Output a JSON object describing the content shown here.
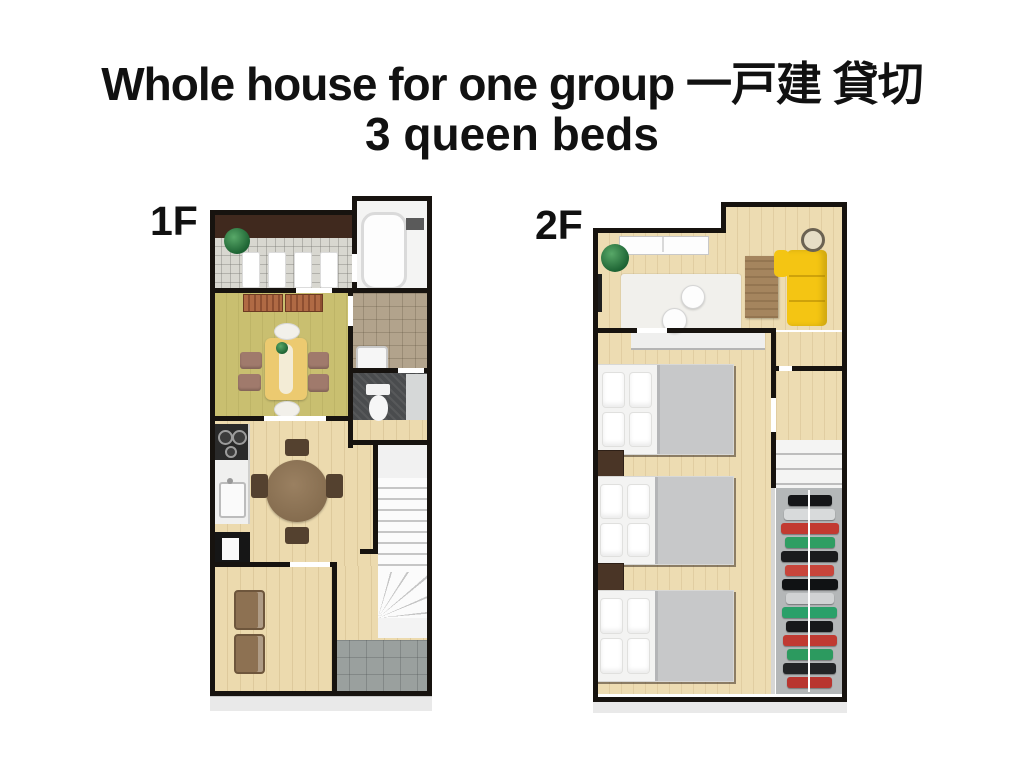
{
  "title": {
    "line1": "Whole house for one group 一戸建 貸切",
    "line2": "3 queen beds"
  },
  "floors": [
    {
      "label": "1F"
    },
    {
      "label": "2F"
    }
  ],
  "palette": {
    "background": "#ffffff",
    "text": "#111111",
    "wall": "#17130f",
    "wall-face": "#e9e9e9",
    "wood-floor": "#ecdaae",
    "wood-floor-2": "#eddcb2",
    "olive-floor": "#c9bf70",
    "tile-entrance": "#d8d7d0",
    "tile-washroom": "#b2a38c",
    "tile-toilet": "#4a4c4e",
    "tile-utility": "#9aa09e",
    "entrance-brown": "#40291e",
    "dining-table": "#ecca70",
    "cushion": "#a07a6c",
    "chair-dark": "#54412f",
    "kitchen-dark": "#2a2a2a",
    "sofa-yellow": "#f4c513",
    "desk-wood": "#a5855e",
    "rug": "#f1f0ec",
    "bed-sheet": "#f3f3f2",
    "bed-blanket": "#c7c8c9",
    "bed-frame": "#3c2f24",
    "nightstand": "#4a3526",
    "stair-tread": "#c6c6c6",
    "closet-back": "#b4b7b8"
  },
  "closet": {
    "clothes_colors": [
      "#151618",
      "#d8dadb",
      "#c23a31",
      "#2f9e63",
      "#1a1b1d",
      "#c8453b",
      "#101214",
      "#d0d2d3",
      "#2aa069",
      "#17181a",
      "#c03a32",
      "#2c9a5f",
      "#222426",
      "#b8352f"
    ]
  }
}
